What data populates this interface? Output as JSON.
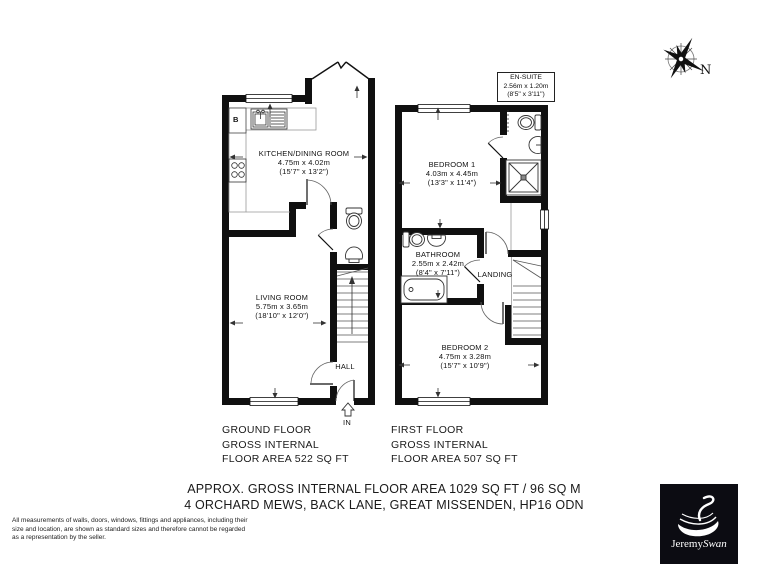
{
  "compass": {
    "north_label": "N"
  },
  "ground_floor": {
    "caption": [
      "GROUND FLOOR",
      "GROSS INTERNAL",
      "FLOOR AREA 522 SQ FT"
    ],
    "rooms": {
      "kitchen": {
        "name": "KITCHEN/DINING ROOM",
        "metric": "4.75m x 4.02m",
        "imperial": "(15'7\" x 13'2\")"
      },
      "living_room": {
        "name": "LIVING ROOM",
        "metric": "5.75m x 3.65m",
        "imperial": "(18'10\" x 12'0\")"
      },
      "hall": {
        "name": "HALL"
      },
      "boiler": {
        "label": "B"
      },
      "entrance": {
        "label": "IN"
      }
    }
  },
  "first_floor": {
    "caption": [
      "FIRST FLOOR",
      "GROSS INTERNAL",
      "FLOOR AREA 507 SQ FT"
    ],
    "rooms": {
      "bedroom1": {
        "name": "BEDROOM 1",
        "metric": "4.03m x 4.45m",
        "imperial": "(13'3\" x 11'4\")"
      },
      "ensuite": {
        "name": "EN-SUITE",
        "metric": "2.56m x 1.20m",
        "imperial": "(8'5\" x 3'11\")"
      },
      "bathroom": {
        "name": "BATHROOM",
        "metric": "2.55m x 2.42m",
        "imperial": "(8'4\" x 7'11\")"
      },
      "landing": {
        "name": "LANDING"
      },
      "bedroom2": {
        "name": "BEDROOM 2",
        "metric": "4.75m x 3.28m",
        "imperial": "(15'7\" x 10'9\")"
      }
    }
  },
  "footer": {
    "area_summary": "APPROX. GROSS INTERNAL FLOOR AREA 1029 SQ FT / 96 SQ M",
    "address": "4 ORCHARD MEWS, BACK LANE, GREAT MISSENDEN, HP16 ODN"
  },
  "disclaimer": "All measurements of walls, doors, windows, fittings and appliances, including their size and location, are shown as standard sizes and therefore cannot be regarded as a representation by the seller.",
  "logo": {
    "brand_regular": "Jeremy",
    "brand_italic": "Swan"
  }
}
